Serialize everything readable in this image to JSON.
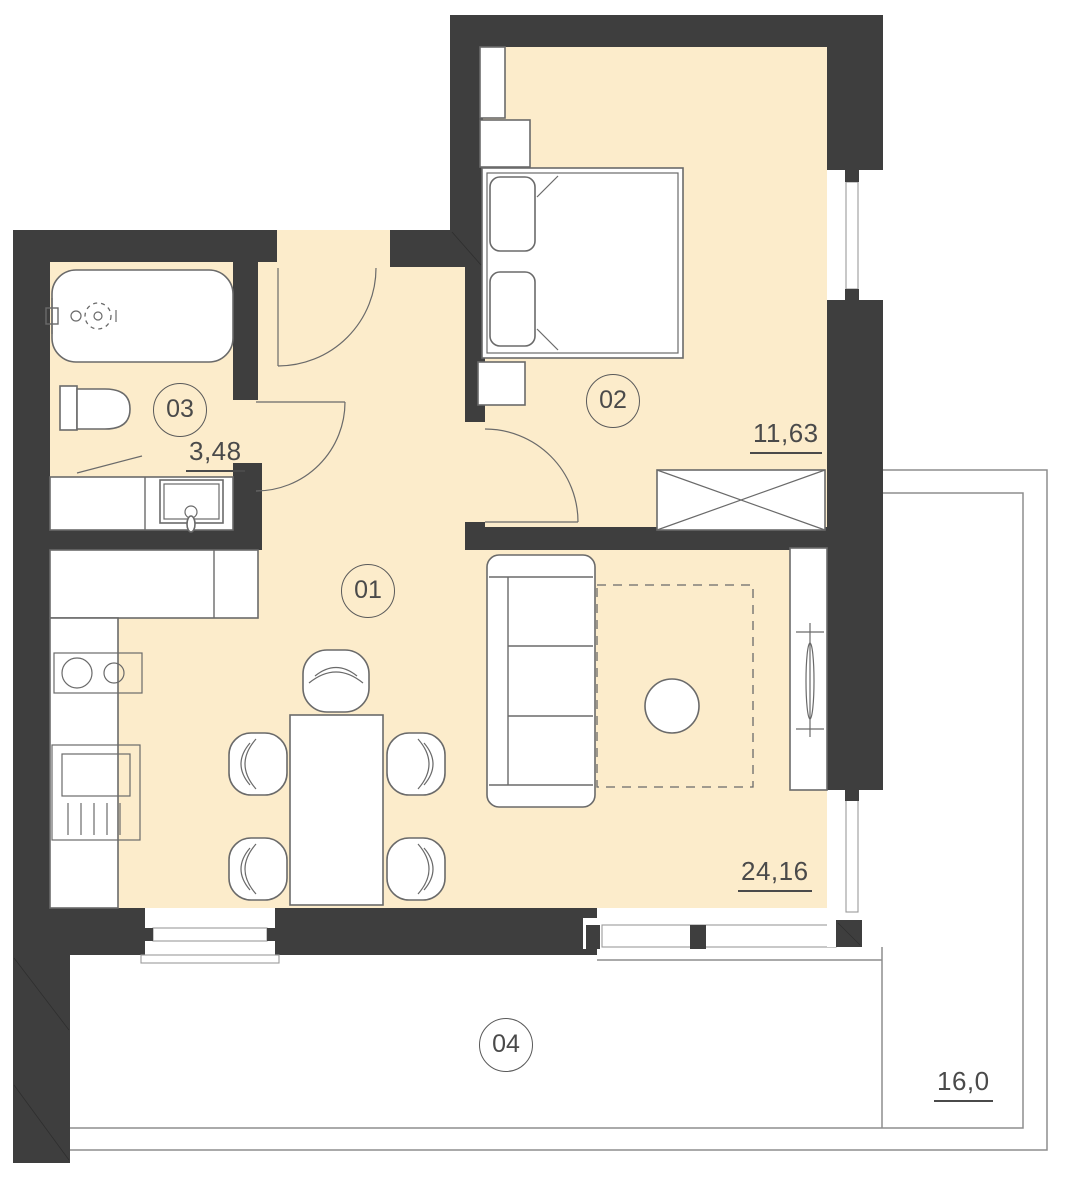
{
  "plan": {
    "title": "apartment-floor-plan",
    "rooms": [
      {
        "number": "01",
        "area": "24,16",
        "type": "living-room-kitchen"
      },
      {
        "number": "02",
        "area": "11,63",
        "type": "bedroom"
      },
      {
        "number": "03",
        "area": "3,48",
        "type": "bathroom"
      },
      {
        "number": "04",
        "area": "16,0",
        "type": "terrace"
      }
    ],
    "colors": {
      "wall": "#3e3e3e",
      "floor": "#fceccb",
      "line": "#6a6a6a",
      "text": "#4a4a4a",
      "bg": "#ffffff"
    },
    "fixtures": [
      "bathtub",
      "toilet",
      "washbasin-counter",
      "kitchen-counter",
      "cooktop",
      "refrigerator",
      "dining-table",
      "chair",
      "sofa",
      "coffee-table",
      "rug",
      "radiator",
      "bed",
      "pillow",
      "nightstand",
      "wardrobe",
      "window",
      "door",
      "terrace-railing"
    ]
  }
}
